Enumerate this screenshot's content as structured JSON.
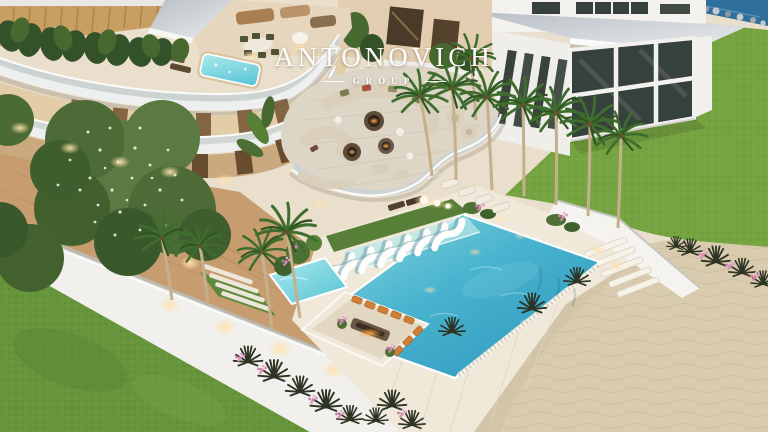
{
  "watermark": {
    "brand": "ANTONOVICH",
    "division": "GROUP"
  },
  "scene": {
    "alt": "Aerial dusk 3D rendering of a modern white luxury villa with curved glass balconies, rooftop jacuzzi, fire-pit lounge terrace, palm trees, large turquoise infinity pool with in-water loungers and sunken seating, lawns, white perimeter wall and sandy beach"
  },
  "palette": {
    "deck": "#e9dfcc",
    "walkway": "#f0e9da",
    "pool_light": "#93dadd",
    "pool_mid": "#49b4cf",
    "pool_deep": "#2a95ba",
    "spa_light": "#aeeaec",
    "spa_deep": "#54c2d4",
    "lawn": "#76a441",
    "lawn_dark": "#67953c",
    "turf": "#587f38",
    "sand": "#d9cbae",
    "building_white": "#f3f2ef",
    "roof_light": "#e9ebed",
    "roof_dark": "#b9bfc6",
    "glass_dark": "#36403c",
    "wood": "#c79d70",
    "louver": "#c99e63",
    "sofa": "#d9cfba",
    "cushion_orange": "#cf8038",
    "foliage": "#4a6b33",
    "foliage_dark": "#3a592b",
    "palm_green": "#3f6d2d",
    "ocean": "#2f6f9b",
    "flower_pink": "#d989b8",
    "warm_glow": "#ffe2ae"
  }
}
